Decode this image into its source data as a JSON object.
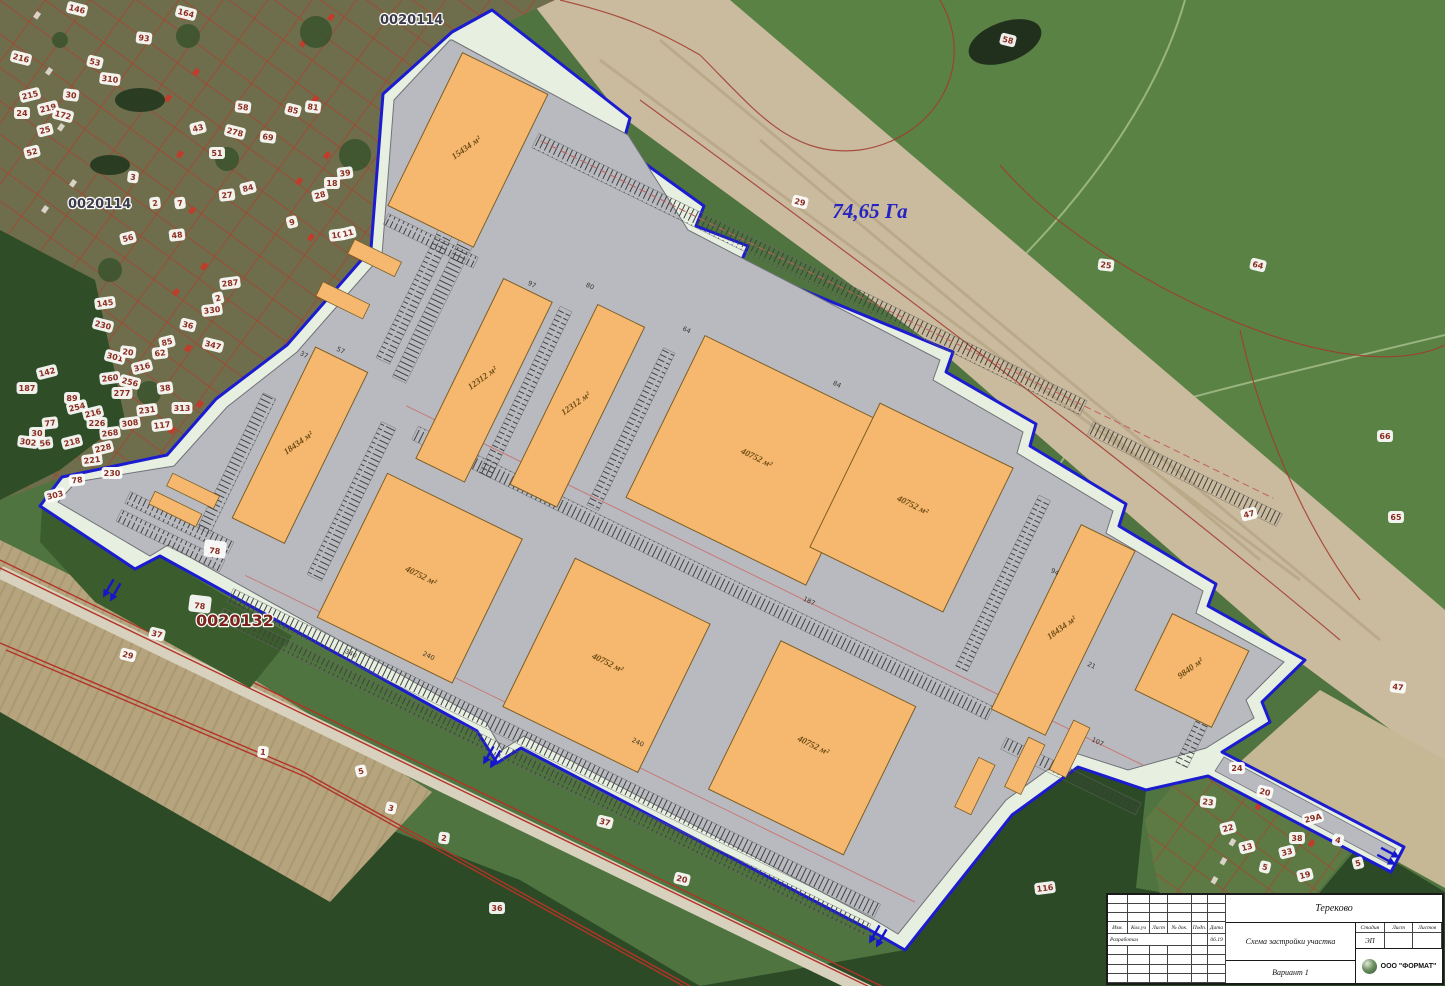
{
  "map": {
    "area_label": "74,65 Га",
    "quarter_top": "0020114",
    "quarter_left": "0020114",
    "quarter_bottom": "0020132",
    "buildings": [
      {
        "label": "15434 м²",
        "u": 226,
        "v": -37,
        "w": 95,
        "h": 170,
        "vert": true
      },
      {
        "label": "12312 м²",
        "u": 362,
        "v": 148,
        "w": 54,
        "h": 200,
        "vert": true
      },
      {
        "label": "12312 м²",
        "u": 458,
        "v": 130,
        "w": 52,
        "h": 200,
        "vert": true
      },
      {
        "label": "40752 м²",
        "u": 568,
        "v": 111,
        "w": 200,
        "h": 180,
        "vert": false
      },
      {
        "label": "40752 м²",
        "u": 755,
        "v": 95,
        "w": 148,
        "h": 160,
        "vert": false
      },
      {
        "label": "18434 м²",
        "u": 223,
        "v": 292,
        "w": 58,
        "h": 190,
        "vert": true
      },
      {
        "label": "40752 м²",
        "u": 343,
        "v": 374,
        "w": 150,
        "h": 160,
        "vert": false
      },
      {
        "label": "40752 м²",
        "u": 549,
        "v": 368,
        "w": 150,
        "h": 165,
        "vert": false
      },
      {
        "label": "40752 м²",
        "u": 770,
        "v": 352,
        "w": 150,
        "h": 165,
        "vert": false
      },
      {
        "label": "18434 м²",
        "u": 989,
        "v": 116,
        "w": 60,
        "h": 205,
        "vert": true
      },
      {
        "label": "9840 м²",
        "u": 1110,
        "v": 156,
        "w": 85,
        "h": 85,
        "vert": true
      }
    ],
    "dimension_marks": [
      {
        "t": "97",
        "u": 390,
        "v": 143
      },
      {
        "t": "80",
        "u": 443,
        "v": 119
      },
      {
        "t": "64",
        "u": 549,
        "v": 116
      },
      {
        "t": "84",
        "u": 708,
        "v": 99
      },
      {
        "t": "94",
        "u": 986,
        "v": 172
      },
      {
        "t": "187",
        "u": 778,
        "v": 306
      },
      {
        "t": "107",
        "u": 1099,
        "v": 306
      },
      {
        "t": "37",
        "u": 216,
        "v": 306
      },
      {
        "t": "240",
        "u": 460,
        "v": 522
      },
      {
        "t": "240",
        "u": 686,
        "v": 508
      },
      {
        "t": "340",
        "u": 389,
        "v": 554
      },
      {
        "t": "57",
        "u": 247,
        "v": 286
      },
      {
        "t": "21",
        "u": 1060,
        "v": 240
      }
    ],
    "parcel_badges": [
      {
        "n": "146",
        "x": 77,
        "y": 9
      },
      {
        "n": "164",
        "x": 186,
        "y": 13
      },
      {
        "n": "93",
        "x": 144,
        "y": 38
      },
      {
        "n": "216",
        "x": 21,
        "y": 58
      },
      {
        "n": "53",
        "x": 95,
        "y": 62
      },
      {
        "n": "310",
        "x": 110,
        "y": 79
      },
      {
        "n": "215",
        "x": 30,
        "y": 95
      },
      {
        "n": "30",
        "x": 71,
        "y": 95
      },
      {
        "n": "219",
        "x": 48,
        "y": 108
      },
      {
        "n": "172",
        "x": 63,
        "y": 115
      },
      {
        "n": "24",
        "x": 22,
        "y": 113
      },
      {
        "n": "25",
        "x": 45,
        "y": 130
      },
      {
        "n": "52",
        "x": 32,
        "y": 152
      },
      {
        "n": "58",
        "x": 243,
        "y": 107
      },
      {
        "n": "85",
        "x": 293,
        "y": 110
      },
      {
        "n": "81",
        "x": 313,
        "y": 107
      },
      {
        "n": "43",
        "x": 198,
        "y": 128
      },
      {
        "n": "278",
        "x": 235,
        "y": 132
      },
      {
        "n": "69",
        "x": 268,
        "y": 137
      },
      {
        "n": "51",
        "x": 217,
        "y": 153
      },
      {
        "n": "3",
        "x": 133,
        "y": 177
      },
      {
        "n": "84",
        "x": 248,
        "y": 188
      },
      {
        "n": "27",
        "x": 227,
        "y": 195
      },
      {
        "n": "39",
        "x": 345,
        "y": 173
      },
      {
        "n": "18",
        "x": 332,
        "y": 183
      },
      {
        "n": "28",
        "x": 320,
        "y": 195
      },
      {
        "n": "2",
        "x": 155,
        "y": 203
      },
      {
        "n": "7",
        "x": 180,
        "y": 203
      },
      {
        "n": "9",
        "x": 292,
        "y": 222
      },
      {
        "n": "10",
        "x": 337,
        "y": 235
      },
      {
        "n": "11",
        "x": 348,
        "y": 233
      },
      {
        "n": "48",
        "x": 177,
        "y": 235
      },
      {
        "n": "56",
        "x": 128,
        "y": 238
      },
      {
        "n": "145",
        "x": 105,
        "y": 303
      },
      {
        "n": "230",
        "x": 103,
        "y": 325
      },
      {
        "n": "36",
        "x": 188,
        "y": 325
      },
      {
        "n": "287",
        "x": 230,
        "y": 283
      },
      {
        "n": "2",
        "x": 218,
        "y": 298
      },
      {
        "n": "330",
        "x": 212,
        "y": 310
      },
      {
        "n": "347",
        "x": 213,
        "y": 345
      },
      {
        "n": "85",
        "x": 167,
        "y": 342
      },
      {
        "n": "62",
        "x": 160,
        "y": 353
      },
      {
        "n": "316",
        "x": 142,
        "y": 367
      },
      {
        "n": "301",
        "x": 115,
        "y": 357
      },
      {
        "n": "20",
        "x": 128,
        "y": 352
      },
      {
        "n": "260",
        "x": 110,
        "y": 378
      },
      {
        "n": "277",
        "x": 122,
        "y": 393
      },
      {
        "n": "256",
        "x": 130,
        "y": 382
      },
      {
        "n": "187",
        "x": 27,
        "y": 388
      },
      {
        "n": "142",
        "x": 47,
        "y": 372
      },
      {
        "n": "89",
        "x": 72,
        "y": 398
      },
      {
        "n": "216",
        "x": 93,
        "y": 413
      },
      {
        "n": "226",
        "x": 97,
        "y": 423
      },
      {
        "n": "254",
        "x": 77,
        "y": 407
      },
      {
        "n": "231",
        "x": 147,
        "y": 410
      },
      {
        "n": "38",
        "x": 165,
        "y": 388
      },
      {
        "n": "313",
        "x": 182,
        "y": 408
      },
      {
        "n": "117",
        "x": 162,
        "y": 425
      },
      {
        "n": "308",
        "x": 130,
        "y": 423
      },
      {
        "n": "268",
        "x": 110,
        "y": 433
      },
      {
        "n": "77",
        "x": 50,
        "y": 423
      },
      {
        "n": "30",
        "x": 37,
        "y": 433
      },
      {
        "n": "56",
        "x": 45,
        "y": 443
      },
      {
        "n": "302",
        "x": 28,
        "y": 442
      },
      {
        "n": "218",
        "x": 72,
        "y": 442
      },
      {
        "n": "228",
        "x": 103,
        "y": 448
      },
      {
        "n": "221",
        "x": 92,
        "y": 460
      },
      {
        "n": "230",
        "x": 112,
        "y": 473
      },
      {
        "n": "303",
        "x": 55,
        "y": 495
      },
      {
        "n": "78",
        "x": 77,
        "y": 480
      },
      {
        "n": "58",
        "x": 1008,
        "y": 40
      },
      {
        "n": "29",
        "x": 800,
        "y": 202
      },
      {
        "n": "25",
        "x": 1106,
        "y": 265
      },
      {
        "n": "64",
        "x": 1258,
        "y": 265
      },
      {
        "n": "66",
        "x": 1385,
        "y": 436
      },
      {
        "n": "65",
        "x": 1396,
        "y": 517
      },
      {
        "n": "47",
        "x": 1249,
        "y": 514
      },
      {
        "n": "47",
        "x": 1398,
        "y": 687
      },
      {
        "n": "78",
        "x": 215,
        "y": 549,
        "s": 13
      },
      {
        "n": "78",
        "x": 200,
        "y": 604,
        "s": 13
      },
      {
        "n": "37",
        "x": 157,
        "y": 634
      },
      {
        "n": "29",
        "x": 128,
        "y": 655
      },
      {
        "n": "1",
        "x": 263,
        "y": 752
      },
      {
        "n": "5",
        "x": 361,
        "y": 771
      },
      {
        "n": "3",
        "x": 391,
        "y": 808
      },
      {
        "n": "2",
        "x": 444,
        "y": 838
      },
      {
        "n": "37",
        "x": 605,
        "y": 822
      },
      {
        "n": "20",
        "x": 682,
        "y": 879
      },
      {
        "n": "36",
        "x": 497,
        "y": 908
      },
      {
        "n": "116",
        "x": 1045,
        "y": 888
      },
      {
        "n": "24",
        "x": 1237,
        "y": 768
      },
      {
        "n": "23",
        "x": 1208,
        "y": 802
      },
      {
        "n": "20",
        "x": 1265,
        "y": 792
      },
      {
        "n": "22",
        "x": 1228,
        "y": 828
      },
      {
        "n": "13",
        "x": 1247,
        "y": 847
      },
      {
        "n": "5",
        "x": 1265,
        "y": 867
      },
      {
        "n": "38",
        "x": 1297,
        "y": 838
      },
      {
        "n": "33",
        "x": 1287,
        "y": 852
      },
      {
        "n": "29А",
        "x": 1313,
        "y": 818
      },
      {
        "n": "4",
        "x": 1338,
        "y": 840
      },
      {
        "n": "5",
        "x": 1358,
        "y": 863
      },
      {
        "n": "19",
        "x": 1305,
        "y": 875
      }
    ]
  },
  "titleblock": {
    "project": "Тереково",
    "doc_title": "Схема застройки участка",
    "variant": "Вариант 1",
    "stage_label": "Стадия",
    "stage_value": "ЭП",
    "sheet_label": "Лист",
    "sheets_label": "Листов",
    "company": "ООО \"ФОРМАТ\"",
    "rev_columns": [
      "Изм.",
      "Кол.уч",
      "Лист",
      "№ док.",
      "Подп.",
      "Дата"
    ],
    "developed_label": "Разработал",
    "date_value": "06.19"
  }
}
